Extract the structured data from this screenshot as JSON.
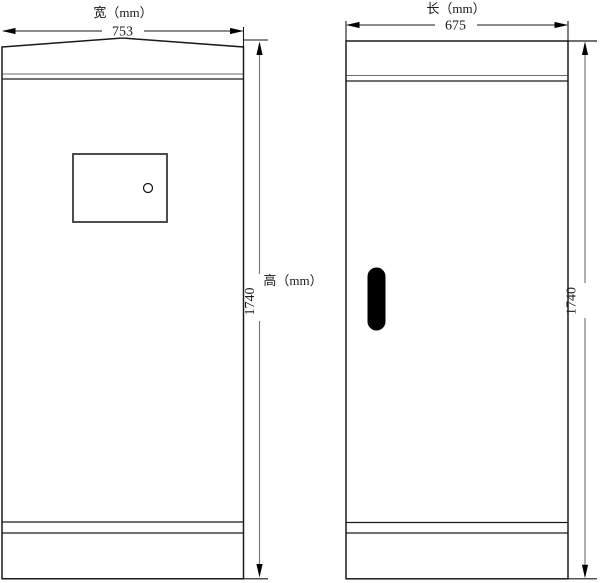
{
  "drawing_type": "cabinet dimension drawing",
  "colors": {
    "background": "#ffffff",
    "outline": "#1a1a1a",
    "dimension_line": "#7a7a7a",
    "handle_fill": "#000000"
  },
  "front_view": {
    "width_label": "宽（mm）",
    "width_value": "753",
    "height_label": "高（mm）",
    "height_value": "1740"
  },
  "side_view": {
    "length_label": "长（mm）",
    "length_value": "675",
    "height_value": "1740"
  }
}
